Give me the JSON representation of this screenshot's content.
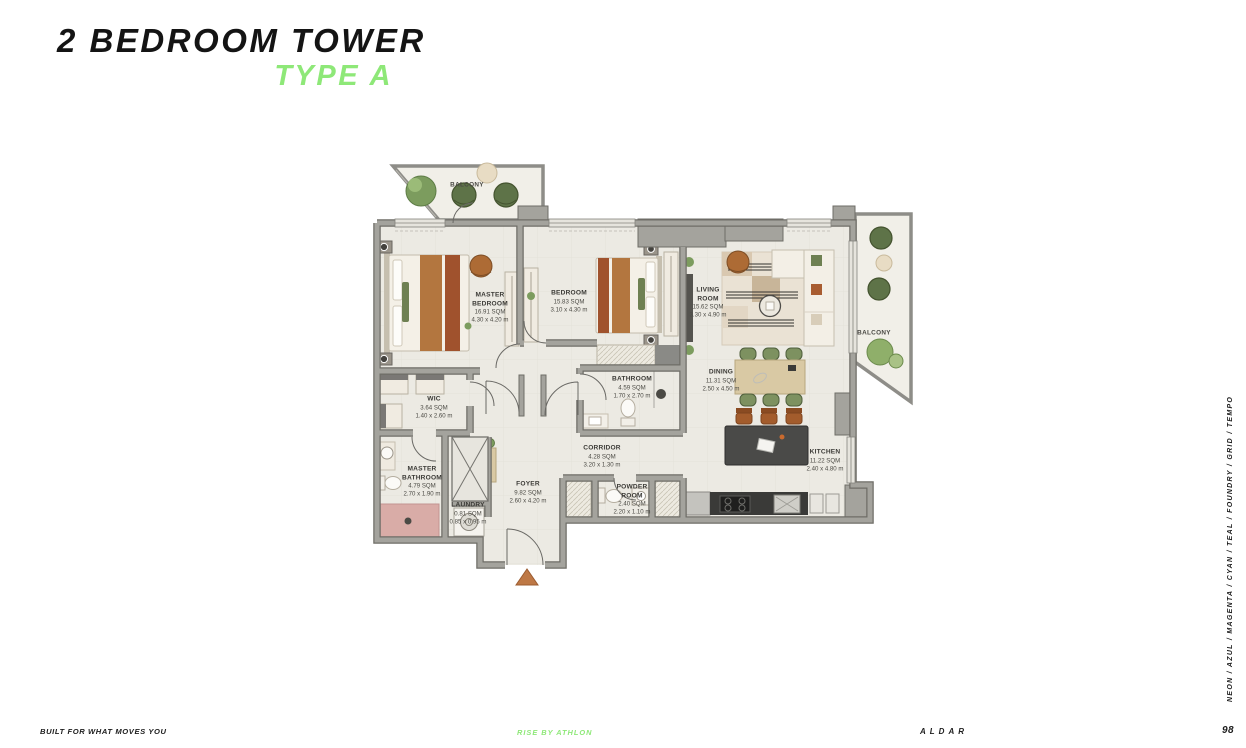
{
  "header": {
    "title": "2 BEDROOM TOWER",
    "subtitle": "TYPE A"
  },
  "plan": {
    "rooms": [
      {
        "id": "master-bedroom",
        "name": "MASTER\nBEDROOM",
        "area": "16.91 SQM",
        "dims": "4.30 x 4.20 m"
      },
      {
        "id": "bedroom",
        "name": "BEDROOM",
        "area": "15.83 SQM",
        "dims": "3.10 x 4.30 m"
      },
      {
        "id": "living-room",
        "name": "LIVING\nROOM",
        "area": "15.62 SQM",
        "dims": "3.30 x 4.90 m"
      },
      {
        "id": "dining",
        "name": "DINING",
        "area": "11.31 SQM",
        "dims": "2.50 x 4.50 m"
      },
      {
        "id": "kitchen",
        "name": "KITCHEN",
        "area": "11.22 SQM",
        "dims": "2.40 x 4.80 m"
      },
      {
        "id": "wic",
        "name": "WIC",
        "area": "3.64 SQM",
        "dims": "1.40 x 2.60 m"
      },
      {
        "id": "bathroom",
        "name": "BATHROOM",
        "area": "4.59 SQM",
        "dims": "1.70 x 2.70 m"
      },
      {
        "id": "master-bathroom",
        "name": "MASTER\nBATHROOM",
        "area": "4.79 SQM",
        "dims": "2.70 x 1.90 m"
      },
      {
        "id": "corridor",
        "name": "CORRIDOR",
        "area": "4.28 SQM",
        "dims": "3.20 x 1.30 m"
      },
      {
        "id": "foyer",
        "name": "FOYER",
        "area": "9.82 SQM",
        "dims": "2.60 x 4.20 m"
      },
      {
        "id": "laundry",
        "name": "LAUNDRY",
        "area": "0.81 SQM",
        "dims": "0.85 x 0.95 m"
      },
      {
        "id": "powder-room",
        "name": "POWDER\nROOM",
        "area": "2.40 SQM",
        "dims": "2.20 x 1.10 m"
      }
    ],
    "balconies": [
      {
        "name": "BALCONY"
      },
      {
        "name": "BALCONY"
      }
    ]
  },
  "sidebar": {
    "text": "NEON  /  AZUL  /  MAGENTA  /  CYAN  /  TEAL  /  FOUNDRY  /  GRID  /  TEMPO"
  },
  "footer": {
    "left": "BUILT FOR WHAT MOVES YOU",
    "center": "RISE BY ATHLON",
    "right": "ALDAR",
    "page": "98"
  },
  "colors": {
    "accent": "#8EE878",
    "wall": "#A4A39D",
    "floor": "#ECEAE3"
  }
}
